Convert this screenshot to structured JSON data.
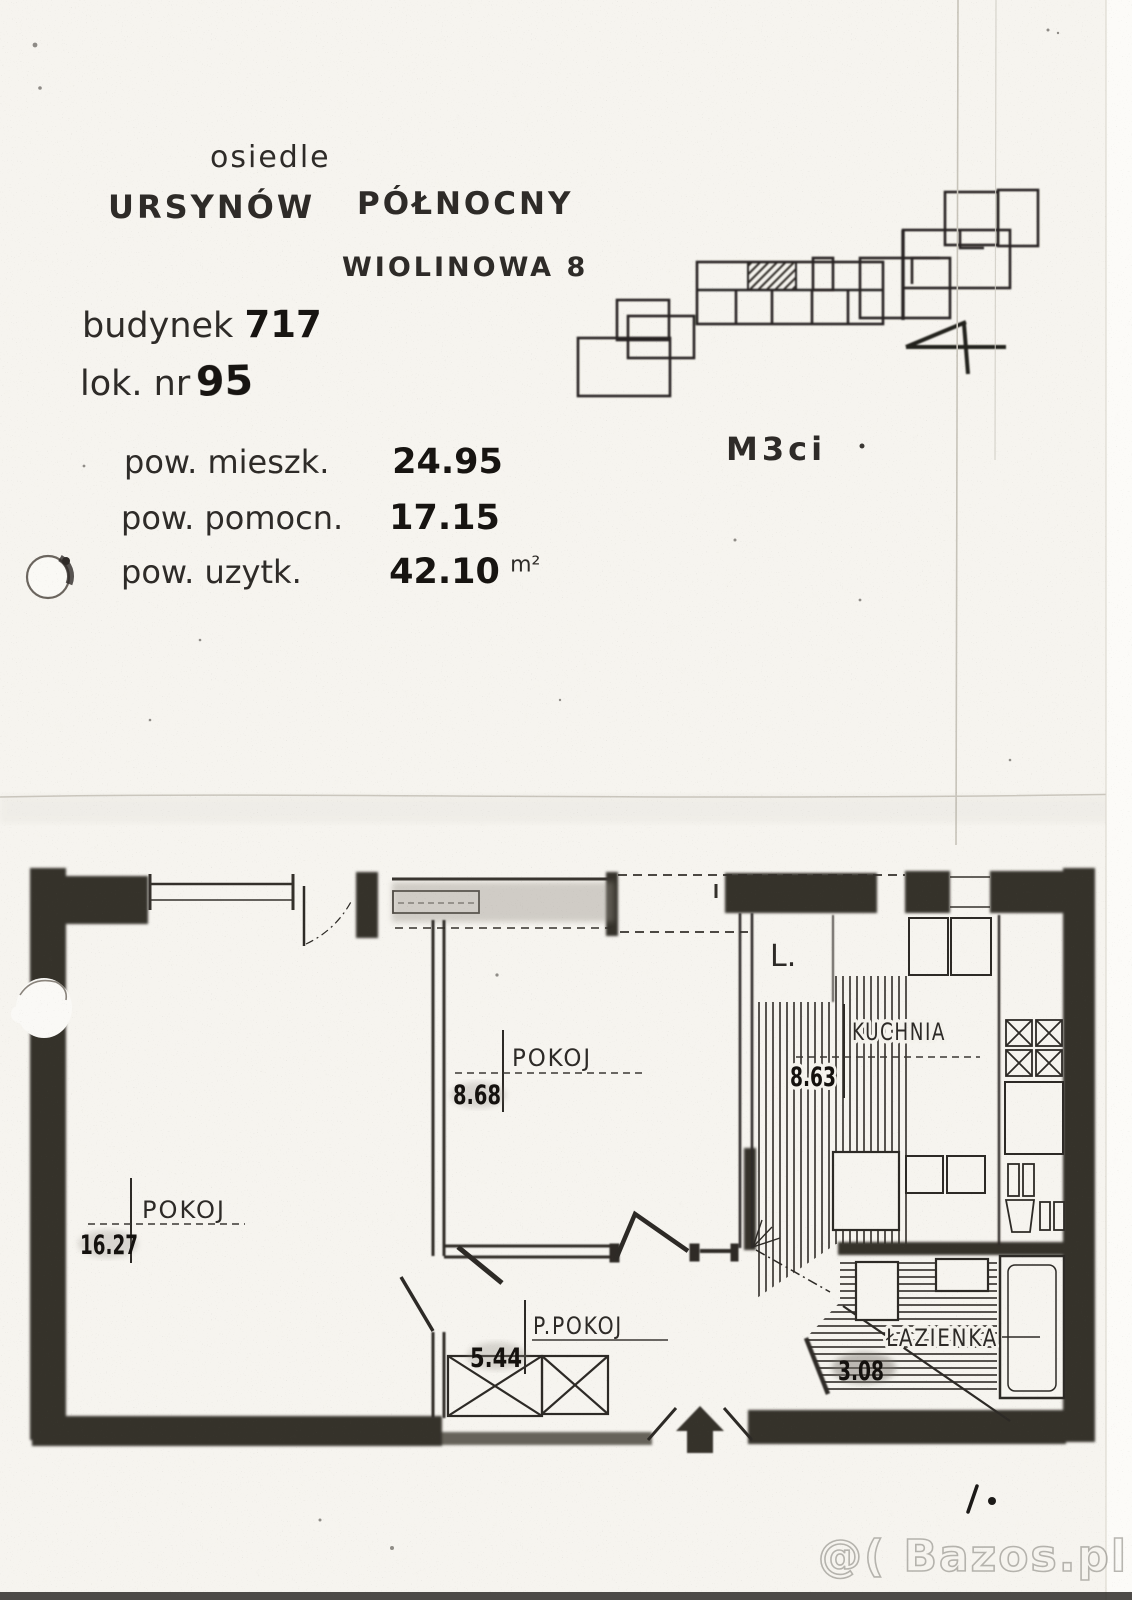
{
  "header": {
    "estate_label": "osiedle",
    "estate_name_1": "URSYNÓW",
    "estate_name_2": "PÓŁNOCNY",
    "street": "WIOLINOWA 8",
    "building_label": "budynek",
    "building_number": "717",
    "unit_label": "lok. nr",
    "unit_number": "95",
    "unit_type": "M3ci"
  },
  "areas": {
    "rows": [
      {
        "label": "pow. mieszk.",
        "value": "24.95",
        "unit": ""
      },
      {
        "label": "pow. pomocn.",
        "value": "17.15",
        "unit": ""
      },
      {
        "label": "pow. uzytk.",
        "value": "42.10",
        "unit": "m²"
      }
    ]
  },
  "floor_plan": {
    "rooms": [
      {
        "name": "POKOJ",
        "area": "16.27"
      },
      {
        "name": "POKOJ",
        "area": "8.68"
      },
      {
        "name": "KUCHNIA",
        "area": "8.63"
      },
      {
        "name": "P.POKOJ",
        "area": "5.44"
      },
      {
        "name": "ŁAZIENKA",
        "area": "3.08"
      }
    ],
    "loggia_label": "L."
  },
  "watermark": "@( Bazos.pl",
  "colors": {
    "paper": "#f6f4ef",
    "ink": "#2b2826",
    "wall": "#343029"
  }
}
